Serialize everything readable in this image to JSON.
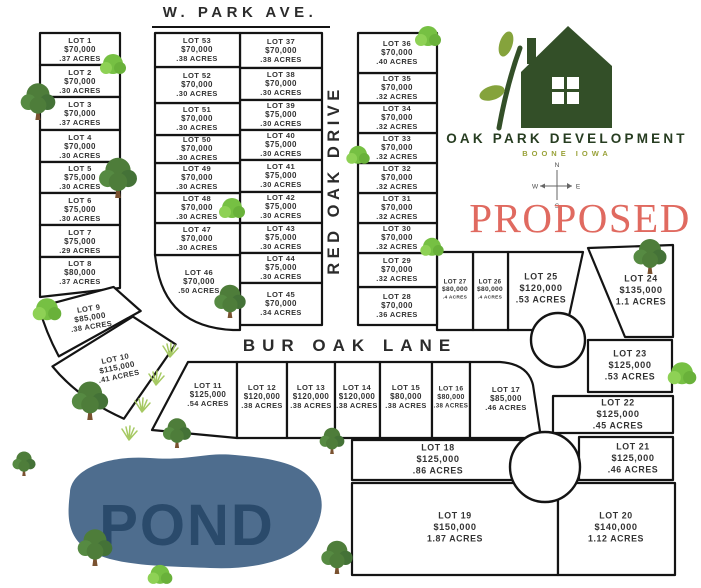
{
  "title": {
    "proposed": "PROPOSED"
  },
  "logo": {
    "company": "OAK PARK DEVELOPMENT",
    "location": "BOONE   IOWA"
  },
  "compass": {
    "n": "N",
    "e": "E",
    "s": "S",
    "w": "W"
  },
  "streets": {
    "w_park_ave": "W. PARK AVE.",
    "red_oak_drive": "RED OAK DRIVE",
    "bur_oak_lane": "BUR OAK LANE"
  },
  "pond": {
    "label": "POND"
  },
  "colors": {
    "line": "#141414",
    "lot_text": "#333333",
    "street_text": "#2b2b2b",
    "house_green": "#334f28",
    "leaf_green": "#85a33c",
    "brand_green": "#273d21",
    "boone_olive": "#9aa23a",
    "proposed_red": "#e06a60",
    "pond_fill": "#4e6d8e",
    "pond_text": "#2a4a6b",
    "tree_green": "#4e7d3a",
    "bush_green": "#76c043",
    "trunk_brown": "#7a5230",
    "grass_green": "#a6c963"
  },
  "lots": [
    {
      "id": 1,
      "name": "LOT 1",
      "price": "$70,000",
      "acres": ".37 ACRES"
    },
    {
      "id": 2,
      "name": "LOT 2",
      "price": "$70,000",
      "acres": ".30 ACRES"
    },
    {
      "id": 3,
      "name": "LOT 3",
      "price": "$70,000",
      "acres": ".37 ACRES"
    },
    {
      "id": 4,
      "name": "LOT 4",
      "price": "$70,000",
      "acres": ".30 ACRES"
    },
    {
      "id": 5,
      "name": "LOT 5",
      "price": "$75,000",
      "acres": ".30 ACRES"
    },
    {
      "id": 6,
      "name": "LOT 6",
      "price": "$75,000",
      "acres": ".30 ACRES"
    },
    {
      "id": 7,
      "name": "LOT 7",
      "price": "$75,000",
      "acres": ".29 ACRES"
    },
    {
      "id": 8,
      "name": "LOT 8",
      "price": "$80,000",
      "acres": ".37 ACRES"
    },
    {
      "id": 9,
      "name": "LOT 9",
      "price": "$85,000",
      "acres": ".38 ACRES"
    },
    {
      "id": 10,
      "name": "LOT 10",
      "price": "$115,000",
      "acres": ".41 ACRES"
    },
    {
      "id": 11,
      "name": "LOT 11",
      "price": "$125,000",
      "acres": ".54 ACRES"
    },
    {
      "id": 12,
      "name": "LOT 12",
      "price": "$120,000",
      "acres": ".38 ACRES"
    },
    {
      "id": 13,
      "name": "LOT 13",
      "price": "$120,000",
      "acres": ".38 ACRES"
    },
    {
      "id": 14,
      "name": "LOT 14",
      "price": "$120,000",
      "acres": ".38 ACRES"
    },
    {
      "id": 15,
      "name": "LOT 15",
      "price": "$80,000",
      "acres": ".38 ACRES"
    },
    {
      "id": 16,
      "name": "LOT 16",
      "price": "$80,000",
      "acres": ".38 ACRES"
    },
    {
      "id": 17,
      "name": "LOT 17",
      "price": "$85,000",
      "acres": ".46 ACRES"
    },
    {
      "id": 18,
      "name": "LOT 18",
      "price": "$125,000",
      "acres": ".86 ACRES"
    },
    {
      "id": 19,
      "name": "LOT 19",
      "price": "$150,000",
      "acres": "1.87 ACRES"
    },
    {
      "id": 20,
      "name": "LOT 20",
      "price": "$140,000",
      "acres": "1.12 ACRES"
    },
    {
      "id": 21,
      "name": "LOT 21",
      "price": "$125,000",
      "acres": ".46 ACRES"
    },
    {
      "id": 22,
      "name": "LOT 22",
      "price": "$125,000",
      "acres": ".45 ACRES"
    },
    {
      "id": 23,
      "name": "LOT 23",
      "price": "$125,000",
      "acres": ".53 ACRES"
    },
    {
      "id": 24,
      "name": "LOT 24",
      "price": "$135,000",
      "acres": "1.1 ACRES"
    },
    {
      "id": 25,
      "name": "LOT 25",
      "price": "$120,000",
      "acres": ".53 ACRES"
    },
    {
      "id": 26,
      "name": "LOT 26",
      "price": "$80,000",
      "acres": ".4 ACRES"
    },
    {
      "id": 27,
      "name": "LOT 27",
      "price": "$80,000",
      "acres": ".4 ACRES"
    },
    {
      "id": 28,
      "name": "LOT 28",
      "price": "$70,000",
      "acres": ".36 ACRES"
    },
    {
      "id": 29,
      "name": "LOT 29",
      "price": "$70,000",
      "acres": ".32 ACRES"
    },
    {
      "id": 30,
      "name": "LOT 30",
      "price": "$70,000",
      "acres": ".32 ACRES"
    },
    {
      "id": 31,
      "name": "LOT 31",
      "price": "$70,000",
      "acres": ".32 ACRES"
    },
    {
      "id": 32,
      "name": "LOT 32",
      "price": "$70,000",
      "acres": ".32 ACRES"
    },
    {
      "id": 33,
      "name": "LOT 33",
      "price": "$70,000",
      "acres": ".32 ACRES"
    },
    {
      "id": 34,
      "name": "LOT 34",
      "price": "$70,000",
      "acres": ".32 ACRES"
    },
    {
      "id": 35,
      "name": "LOT 35",
      "price": "$70,000",
      "acres": ".32 ACRES"
    },
    {
      "id": 36,
      "name": "LOT 36",
      "price": "$70,000",
      "acres": ".40 ACRES"
    },
    {
      "id": 37,
      "name": "LOT 37",
      "price": "$70,000",
      "acres": ".38 ACRES"
    },
    {
      "id": 38,
      "name": "LOT 38",
      "price": "$70,000",
      "acres": ".30 ACRES"
    },
    {
      "id": 39,
      "name": "LOT 39",
      "price": "$75,000",
      "acres": ".30 ACRES"
    },
    {
      "id": 40,
      "name": "LOT 40",
      "price": "$75,000",
      "acres": ".30 ACRES"
    },
    {
      "id": 41,
      "name": "LOT 41",
      "price": "$75,000",
      "acres": ".30 ACRES"
    },
    {
      "id": 42,
      "name": "LOT 42",
      "price": "$75,000",
      "acres": ".30 ACRES"
    },
    {
      "id": 43,
      "name": "LOT 43",
      "price": "$75,000",
      "acres": ".30 ACRES"
    },
    {
      "id": 44,
      "name": "LOT 44",
      "price": "$75,000",
      "acres": ".30 ACRES"
    },
    {
      "id": 45,
      "name": "LOT 45",
      "price": "$70,000",
      "acres": ".34 ACRES"
    },
    {
      "id": 46,
      "name": "LOT 46",
      "price": "$70,000",
      "acres": ".50 ACRES"
    },
    {
      "id": 47,
      "name": "LOT 47",
      "price": "$70,000",
      "acres": ".30 ACRES"
    },
    {
      "id": 48,
      "name": "LOT 48",
      "price": "$70,000",
      "acres": ".30 ACRES"
    },
    {
      "id": 49,
      "name": "LOT 49",
      "price": "$70,000",
      "acres": ".30 ACRES"
    },
    {
      "id": 50,
      "name": "LOT 50",
      "price": "$70,000",
      "acres": ".30 ACRES"
    },
    {
      "id": 51,
      "name": "LOT 51",
      "price": "$70,000",
      "acres": ".30 ACRES"
    },
    {
      "id": 52,
      "name": "LOT 52",
      "price": "$70,000",
      "acres": ".30 ACRES"
    },
    {
      "id": 53,
      "name": "LOT 53",
      "price": "$70,000",
      "acres": ".38 ACRES"
    }
  ]
}
